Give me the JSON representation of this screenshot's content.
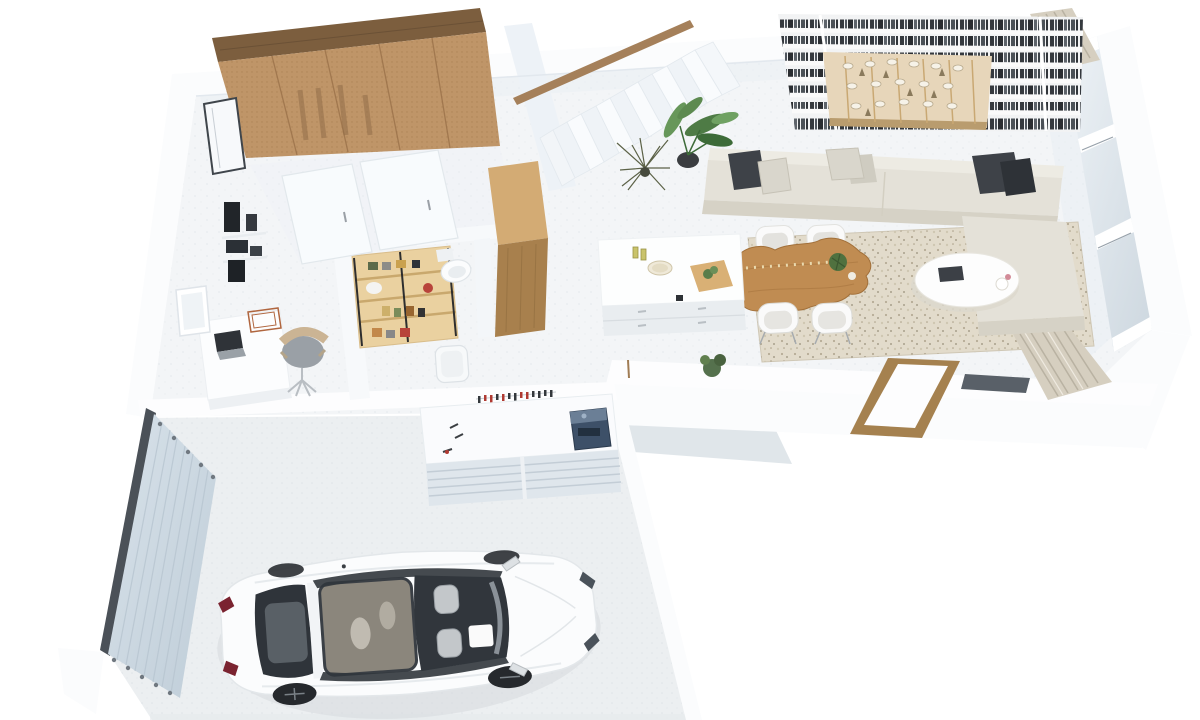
{
  "scene": {
    "type": "3d-floor-plan-render",
    "rooms": [
      "garage",
      "kitchen",
      "home-office-nook",
      "pantry",
      "bathroom",
      "walk-in-closet",
      "stairwell",
      "living-room",
      "dining-area",
      "entry"
    ]
  },
  "colors": {
    "background": "#ffffff",
    "wall_face": "#fbfcfd",
    "wall_shadow": "#e4eaf0",
    "floor": "#f3f5f7",
    "garage_floor": "#eceff1",
    "porch": "#dde3e8",
    "closet_wood_top": "#7c5e3e",
    "closet_mesh": "#bf9568",
    "handrail_wood": "#a5805a",
    "cabinet_wood_light": "#d3ab74",
    "cabinet_wood_dark": "#a8804d",
    "pantry_wood": "#ead1a0",
    "table_wood": "#c08c52",
    "door_frame_wood": "#a5814f",
    "bookshelf_white": "#f2f3f4",
    "bookshelf_wood": "#e7d6ba",
    "sofa_body": "#e4e1d8",
    "sofa_shadow": "#d6d2c6",
    "pillow_dark": "#3e4248",
    "pillow_light": "#d9d6cc",
    "rug_base": "#e2dbcb",
    "chair_white": "#fafafa",
    "glass_dark": "#596068",
    "curtain": "#d6cfc0",
    "garage_door": "#ccd9e4",
    "garage_door_rail": "#4b5158",
    "toolbox_blue": "#3d5068",
    "workbench_front": "#dfe6ec",
    "tool_red": "#b03a32",
    "car_body": "#fbfcfd",
    "car_glass_dark": "#2f343a",
    "car_sunroof": "#8b867c",
    "car_taillight": "#7a2330",
    "plant_green": "#4e7b45",
    "plant_olive": "#5c6247",
    "desk_white": "#fcfdfe",
    "chair_tan": "#cbb494"
  },
  "objects": {
    "closet": "Walk-in closet with perforated sliding front",
    "handrail": "Wooden stair handrail",
    "stairs": "White staircase",
    "bookshelf": "Full-wall bookshelf",
    "sofa": "Beige sectional sofa",
    "rug": "Speckled area rug",
    "coffee_table": "White oval coffee table",
    "dining_table": "Live-edge wood dining table",
    "dining_chairs": "White dining chairs",
    "island": "Kitchen island",
    "wood_cabinet": "Tall wooden cabinet",
    "pantry_shelf": "Wooden pantry shelving",
    "toilet": "Toilet",
    "bin": "White bin",
    "desk": "Home office desk",
    "office_chair": "Office chair",
    "wall_shelf": "Wall shelf with books",
    "sliding_doors": "White sliding doors",
    "front_door": "Front door",
    "left_window": "Side window",
    "window_wall": "Floor-to-ceiling window wall",
    "curtain_top": "Curtain",
    "curtain_bottom": "Curtain",
    "entry_door": "Wood-framed entry door",
    "dark_pane": "Dark glass pane",
    "garage_door": "Sliding garage door",
    "workbench": "Garage workbench",
    "toolbox": "Blue toolbox",
    "tools": "Wall-mounted tools",
    "car": "White sedan",
    "plant_large": "Potted plant",
    "plant_dry": "Dried plant",
    "plant_entry": "Small plant",
    "plant_table": "Table plant",
    "porch": "Entry porch",
    "walls": "White walls",
    "floors": "Floor"
  }
}
